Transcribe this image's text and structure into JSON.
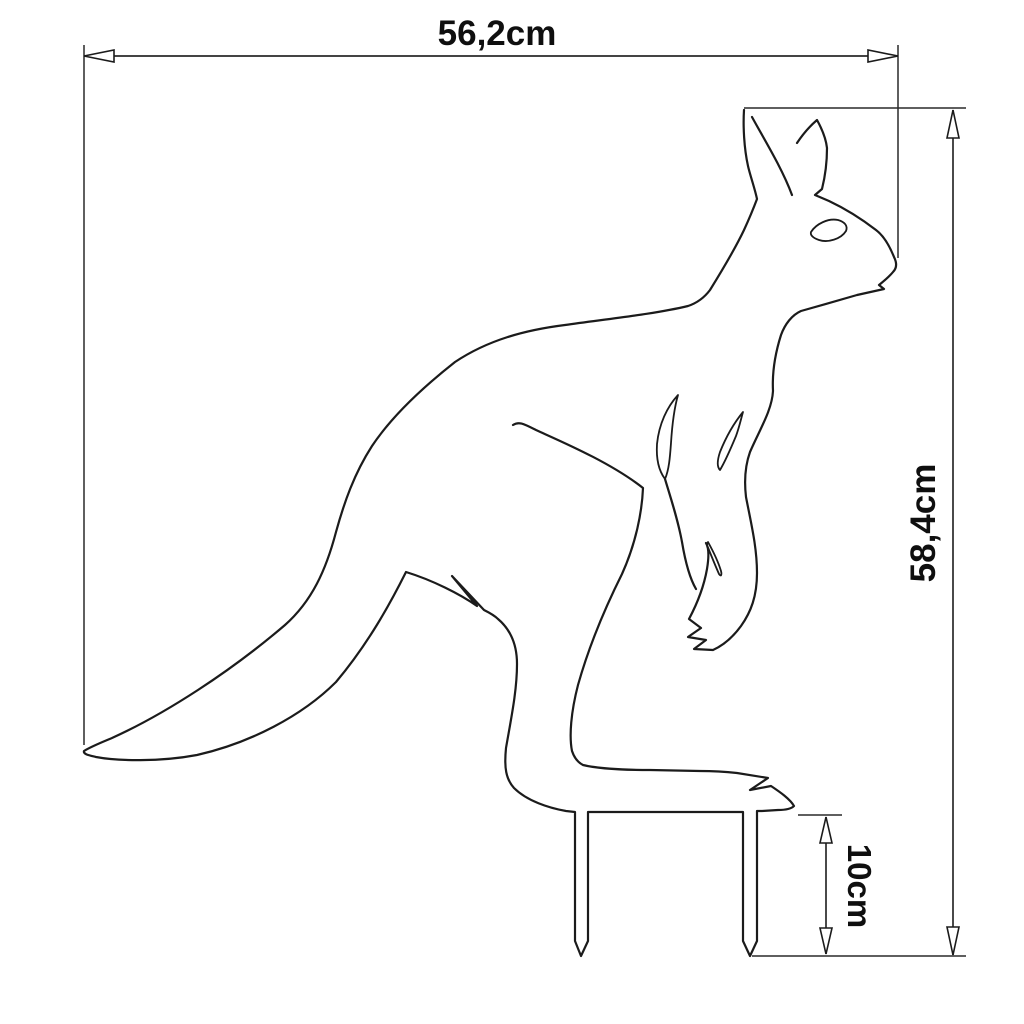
{
  "page": {
    "background": "#ffffff"
  },
  "diagram": {
    "subject": "kangaroo-silhouette-garden-stake",
    "dimensions": {
      "width": {
        "label": "56,2cm"
      },
      "height": {
        "label": "58,4cm"
      },
      "stake": {
        "label": "10cm"
      }
    },
    "style": {
      "line_color": "#1b1b1b",
      "dimension_line_color": "#2a2a2a",
      "text_color": "#0f0f0f",
      "arrowhead_style": "open-triangle"
    }
  }
}
